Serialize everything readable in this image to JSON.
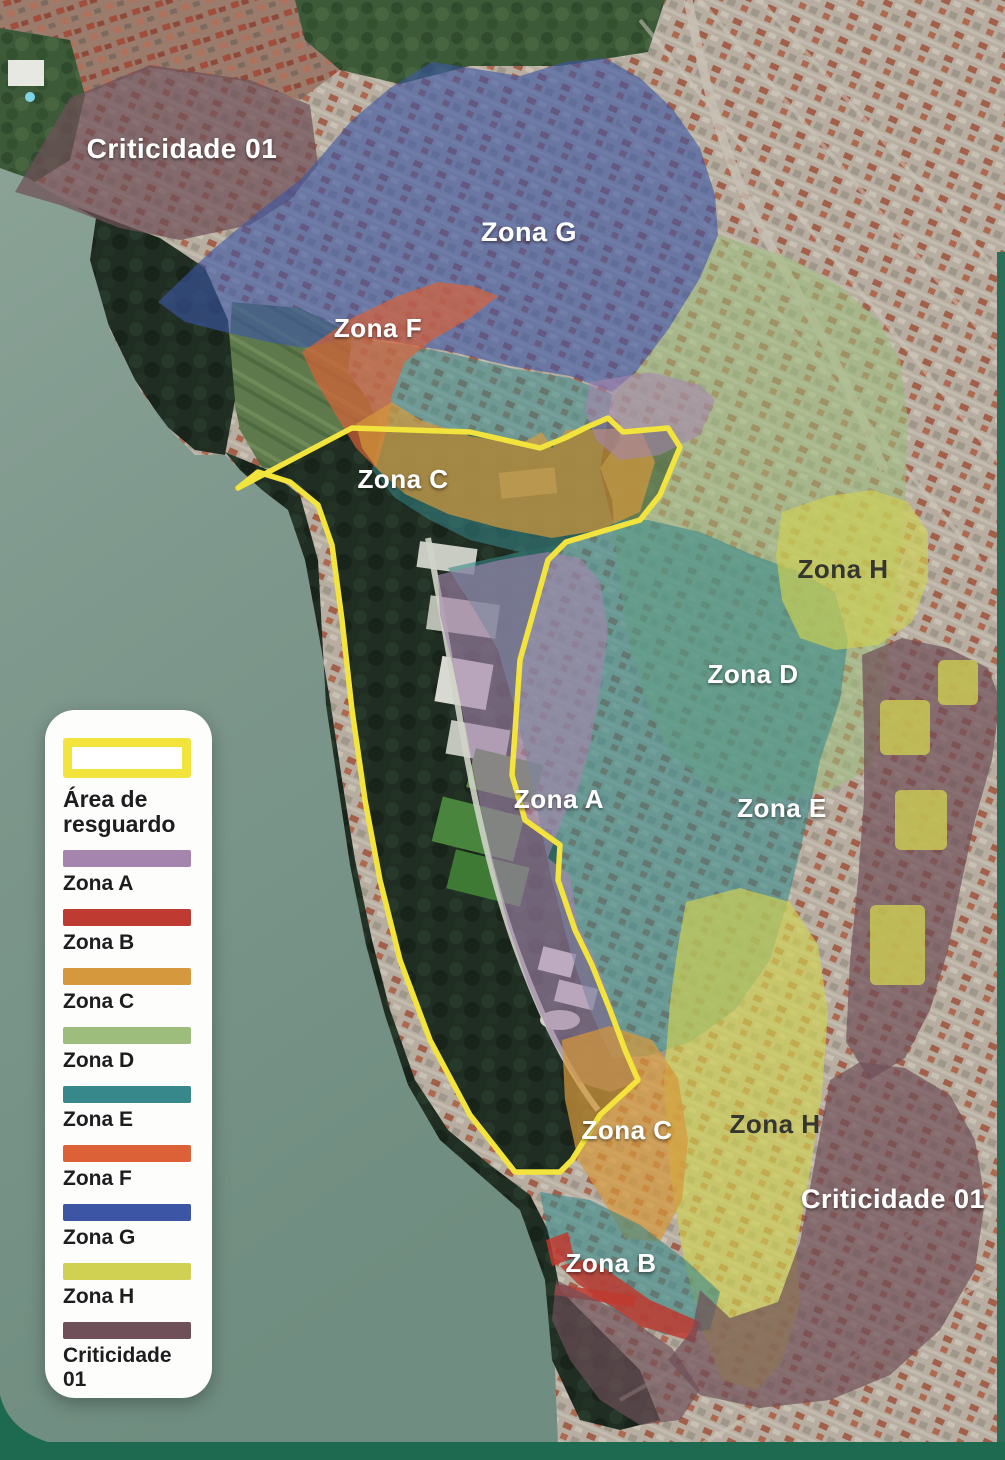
{
  "map": {
    "labels": [
      {
        "text": "Criticidade 01",
        "color": "#ffffff"
      },
      {
        "text": "Zona G",
        "color": "#ffffff"
      },
      {
        "text": "Zona F",
        "color": "#ffffff"
      },
      {
        "text": "Zona C",
        "color": "#ffffff"
      },
      {
        "text": "Zona H",
        "color": "#35362f"
      },
      {
        "text": "Zona D",
        "color": "#ffffff"
      },
      {
        "text": "Zona A",
        "color": "#ffffff"
      },
      {
        "text": "Zona E",
        "color": "#ffffff"
      },
      {
        "text": "Zona C",
        "color": "#ffffff"
      },
      {
        "text": "Zona H",
        "color": "#35362f"
      },
      {
        "text": "Criticidade 01",
        "color": "#ffffff"
      },
      {
        "text": "Zona B",
        "color": "#ffffff"
      }
    ]
  },
  "legend": {
    "area_item": {
      "label": "Área de resguardo",
      "color": "#f2e43c"
    },
    "items": [
      {
        "label": "Zona A",
        "color": "#a585ad"
      },
      {
        "label": "Zona B",
        "color": "#bf3a30"
      },
      {
        "label": "Zona C",
        "color": "#d6983c"
      },
      {
        "label": "Zona D",
        "color": "#9cbd7c"
      },
      {
        "label": "Zona E",
        "color": "#37888b"
      },
      {
        "label": "Zona F",
        "color": "#dd6136"
      },
      {
        "label": "Zona G",
        "color": "#3c55a4"
      },
      {
        "label": "Zona H",
        "color": "#d0d152"
      },
      {
        "label": "Criticidade 01",
        "color": "#6f4f58"
      }
    ]
  }
}
